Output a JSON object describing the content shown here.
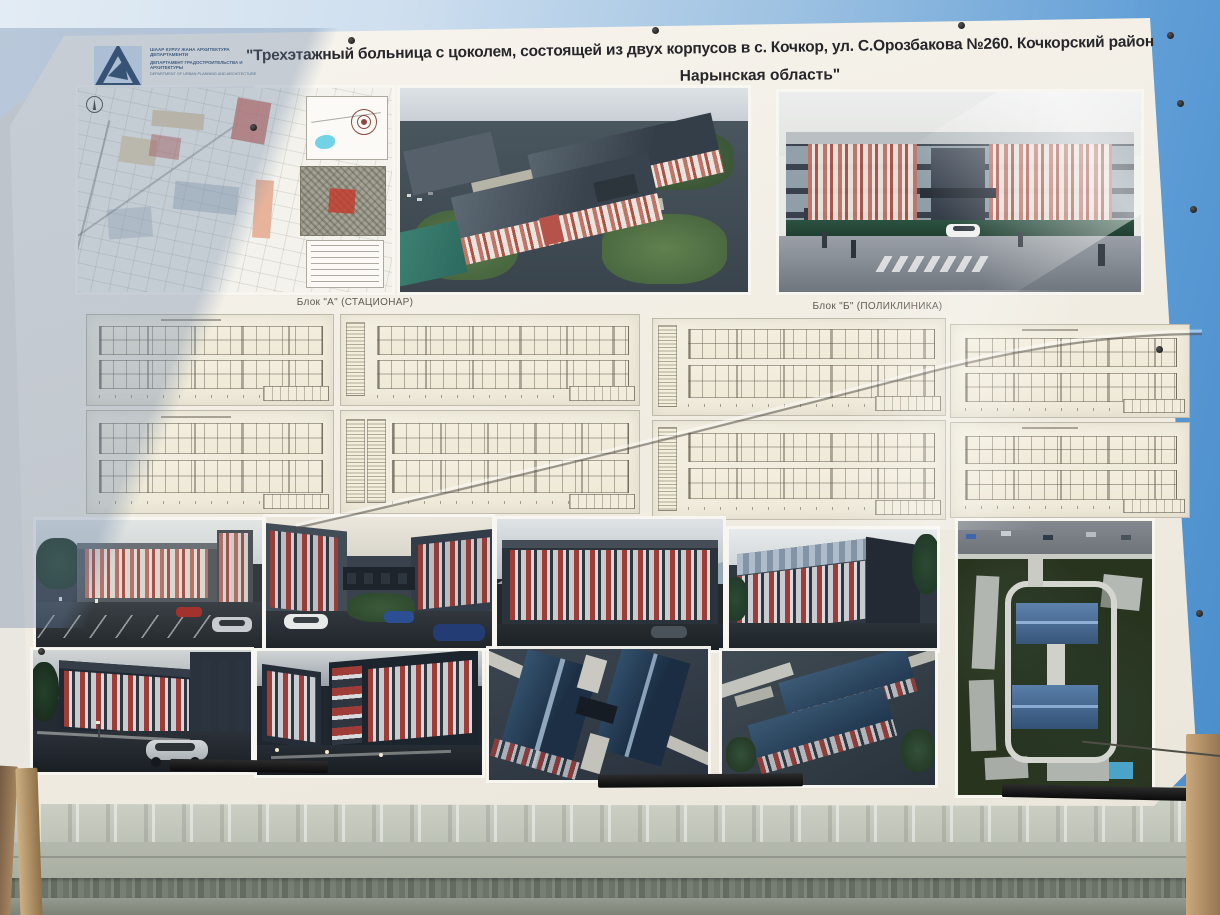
{
  "billboard": {
    "title_line1": "\"Трехэтажный больница с цоколем, состоящей из двух корпусов в с. Кочкор, ул. С.Орозбакова №260. Кочкорский район",
    "title_line2": "Нарынская область\"",
    "logo": {
      "lines": [
        "ШААР КУРУУ ЖАНА АРХИТЕКТУРА ДЕПАРТАМЕНТИ",
        "ДЕПАРТАМЕНТ ГРАДОСТРОИТЕЛЬСТВА И АРХИТЕКТУРЫ",
        "DEPARTMENT OF URBAN PLANNING AND ARCHITECTURE"
      ]
    },
    "section_labels": {
      "block_a": "Блок \"А\" (СТАЦИОНАР)",
      "block_b": "Блок \"Б\" (ПОЛИКЛИНИКА)"
    },
    "colors": {
      "sky_left": "#e3ecf4",
      "sky_right": "#478cca",
      "banner_paper": "#f1ede3",
      "facade_red": "#b05a50",
      "night_navy": "#1f2833",
      "roof_blue": "#3f5e82",
      "metal_wall": "#b7bcb0",
      "wood_pole": "#b3926c",
      "logo_navy": "#223c58"
    }
  }
}
